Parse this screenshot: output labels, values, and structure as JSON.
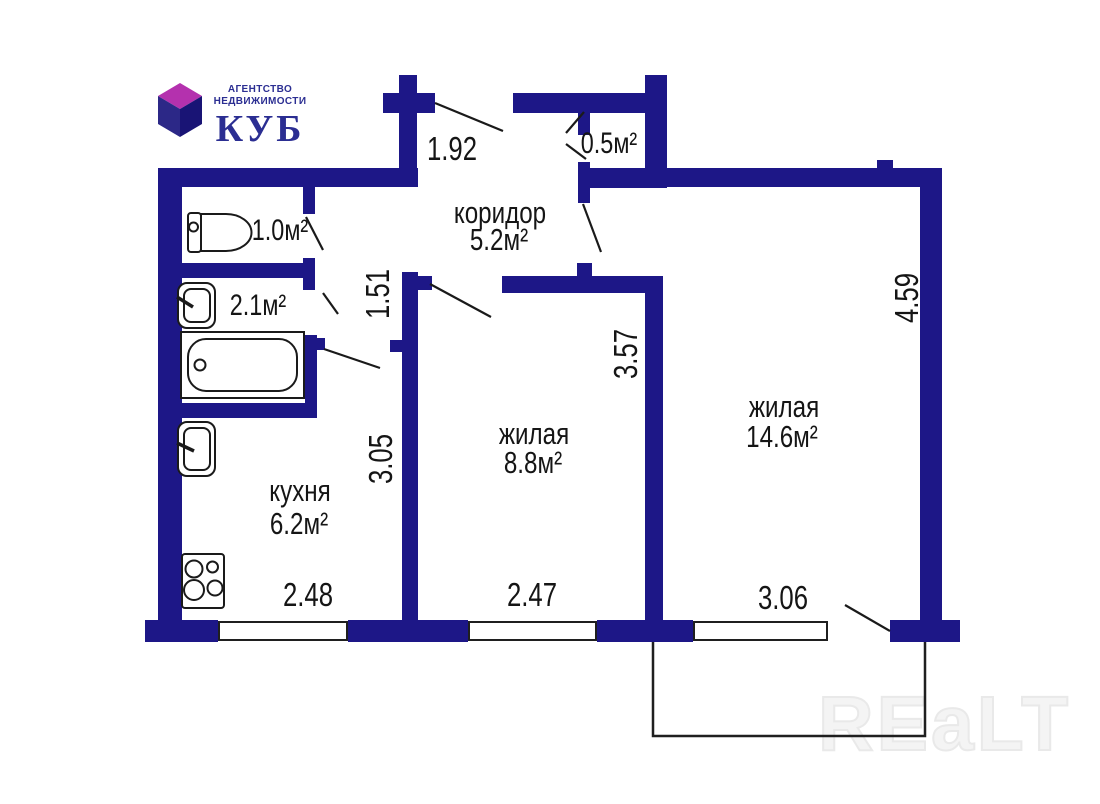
{
  "logo": {
    "tagline_line1": "АГЕНТСТВО",
    "tagline_line2": "НЕДВИЖИМОСТИ",
    "brand": "КУБ"
  },
  "rooms": {
    "corridor": {
      "name": "коридор",
      "area": "5.2м²"
    },
    "closet": {
      "area": "0.5м²"
    },
    "wc": {
      "area": "1.0м²"
    },
    "bathroom": {
      "area": "2.1м²"
    },
    "kitchen": {
      "name": "кухня",
      "area": "6.2м²"
    },
    "living1": {
      "name": "жилая",
      "area": "8.8м²"
    },
    "living2": {
      "name": "жилая",
      "area": "14.6м²"
    }
  },
  "dimensions": {
    "entry_width": "1.92",
    "hallway_depth": "1.51",
    "kitchen_depth": "3.05",
    "living1_depth": "3.57",
    "living2_depth": "4.59",
    "kitchen_width": "2.48",
    "living1_width": "2.47",
    "living2_width": "3.06"
  },
  "watermark": "REaLT",
  "colors": {
    "wall": "#1d1787",
    "line": "#1a1a1a",
    "logo_cube_top": "#b431ae",
    "logo_cube_left": "#2c2887",
    "logo_cube_right": "#191475",
    "logo_text": "#2b2e92",
    "watermark_gray": "#e9e9e9"
  }
}
